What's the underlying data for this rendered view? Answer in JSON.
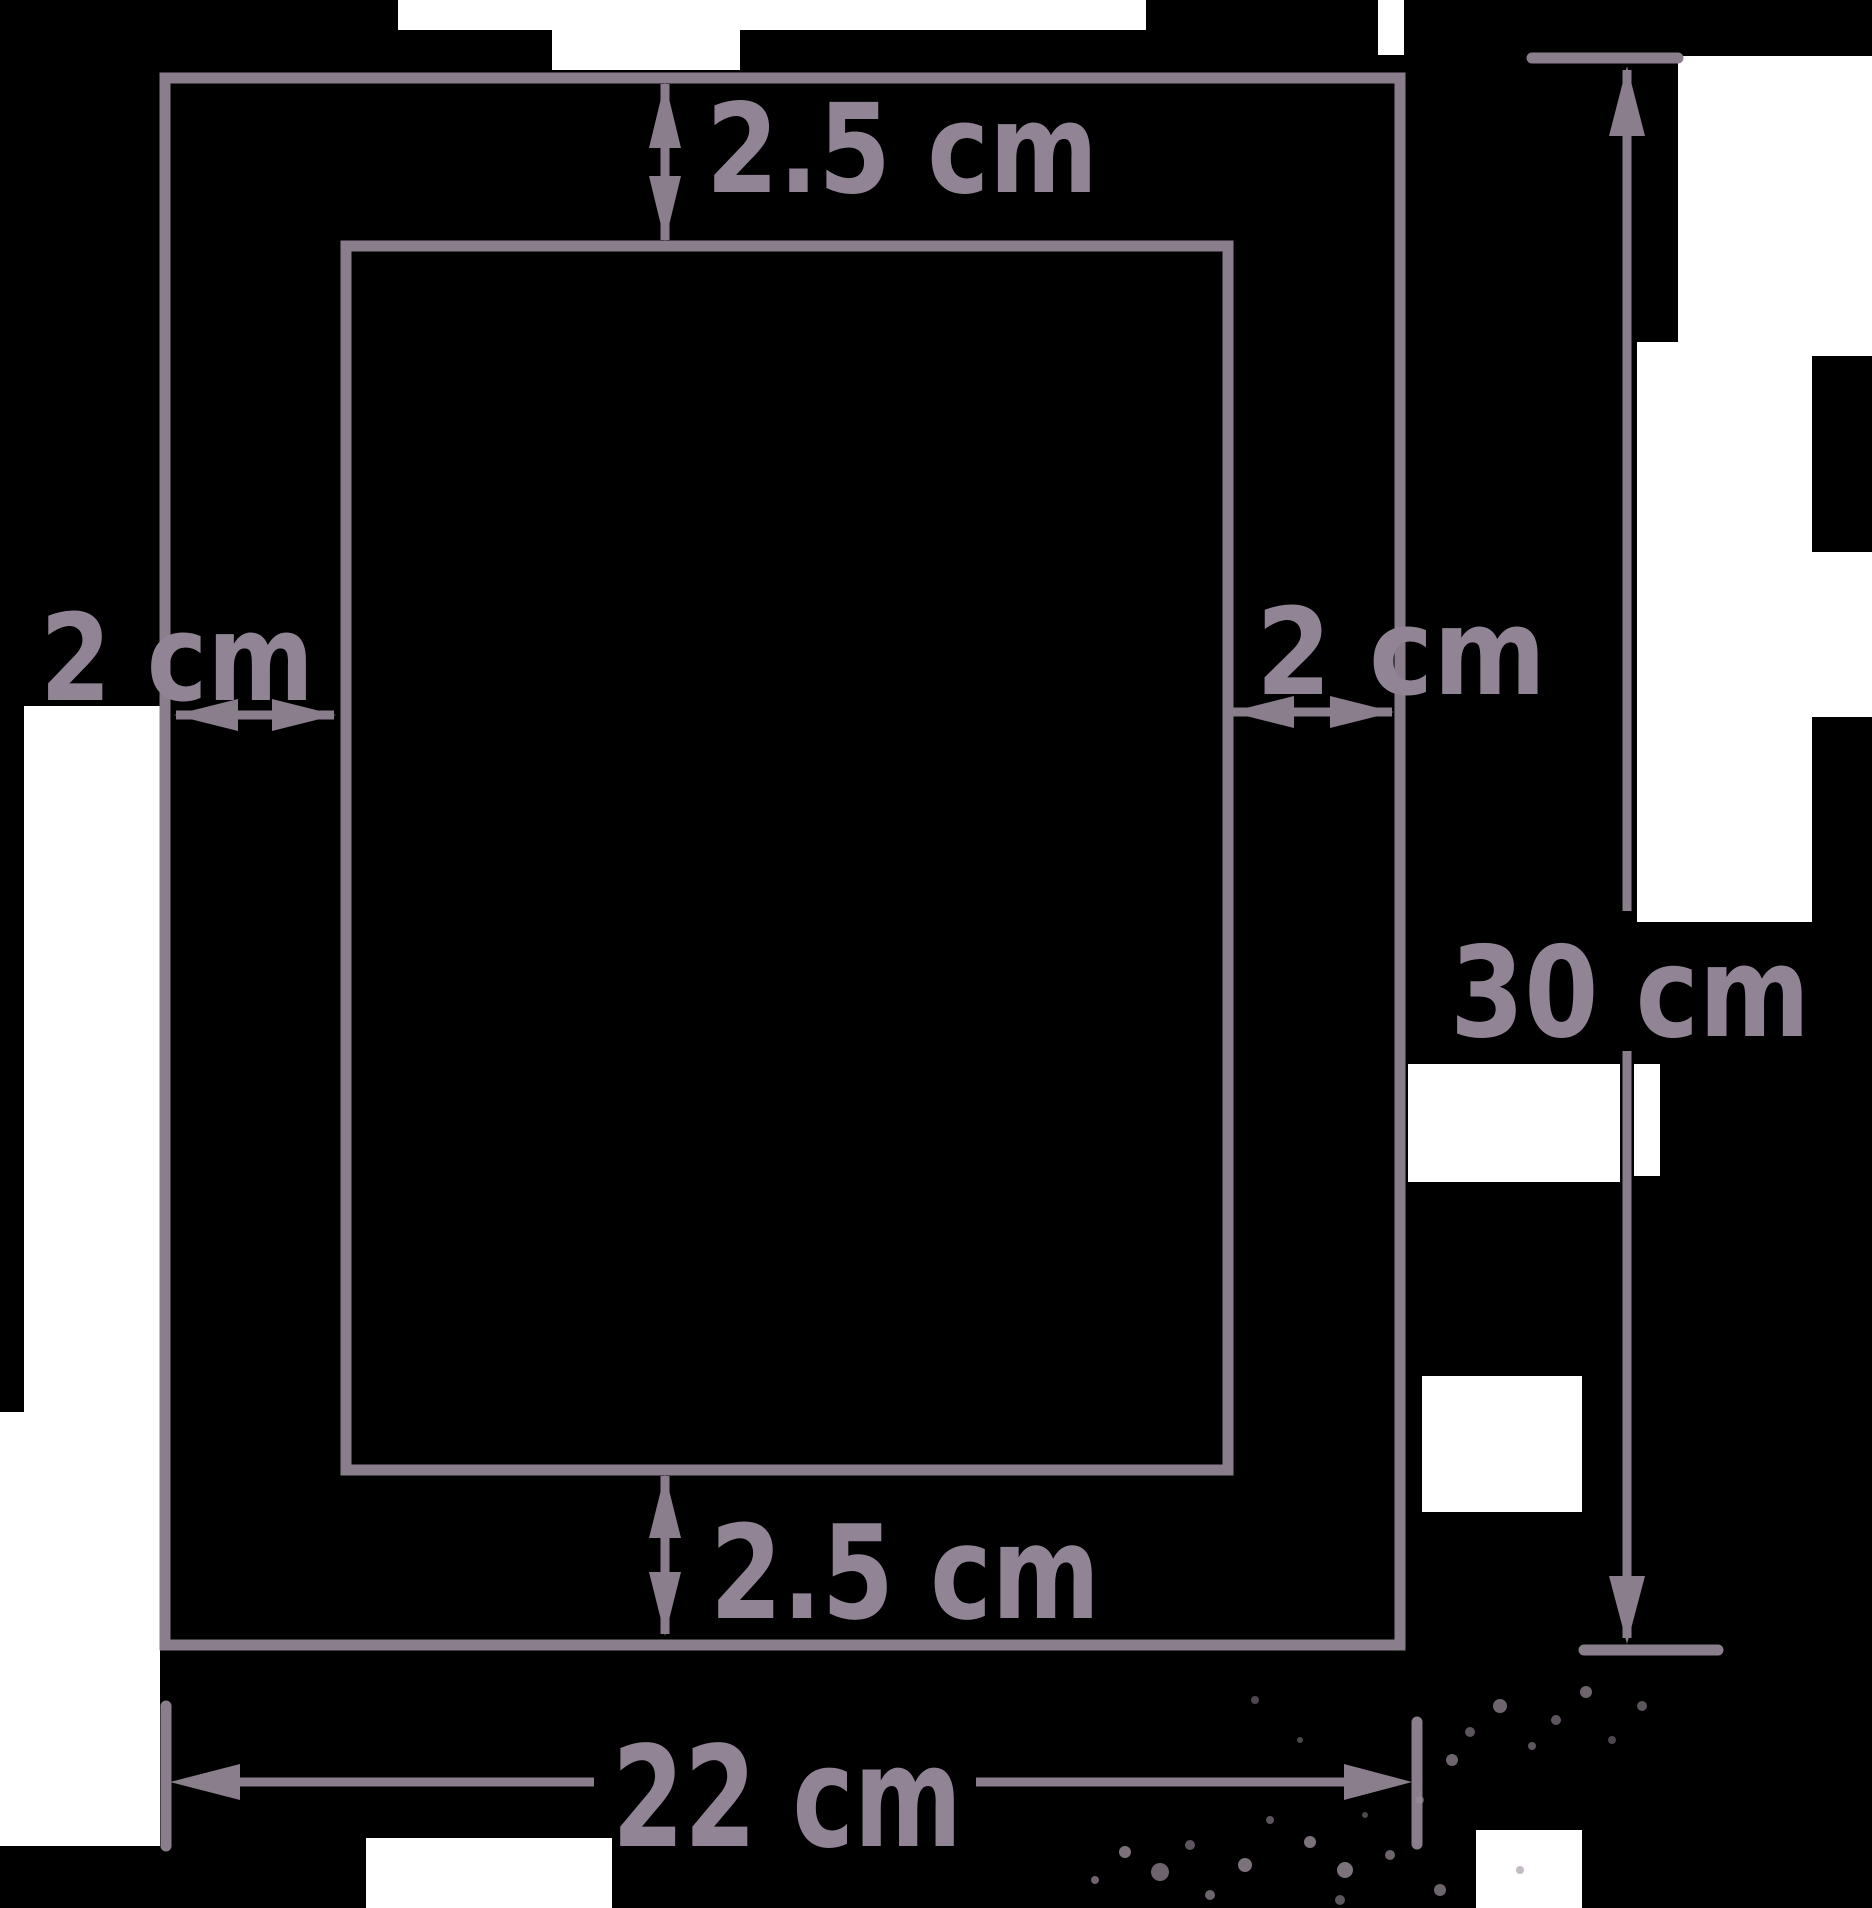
{
  "diagram": {
    "type": "rectangle-with-hatched-inner-rectangle-and-margins",
    "background_color": "#000000",
    "stroke_color": "#8a7e8c",
    "text_color": "#918595",
    "patch_color": "#ffffff",
    "speckle_color": "#9b8e9b",
    "labels": {
      "top_margin": "2.5 cm",
      "bottom_margin": "2.5 cm",
      "left_margin": "2 cm",
      "right_margin": "2 cm",
      "total_height": "30 cm",
      "total_width": "22 cm"
    }
  }
}
